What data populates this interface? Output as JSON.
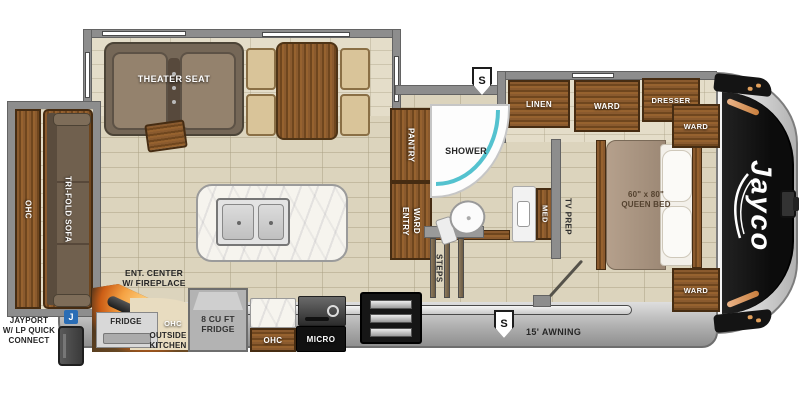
{
  "logo": {
    "brand": "Jayco"
  },
  "badges": {
    "s_top": "S",
    "s_bottom": "S",
    "jayport_j": "J"
  },
  "rear_slide": {
    "ohc": "OHC",
    "sofa": "TRI-FOLD SOFA"
  },
  "living": {
    "theater": "THEATER SEAT"
  },
  "outside_kitchen": {
    "ent_l1": "ENT. CENTER",
    "ent_l2": "W/ FIREPLACE",
    "fridge": "FRIDGE",
    "title_l1": "OUTSIDE",
    "title_l2": "KITCHEN",
    "ohc": "OHC"
  },
  "kitchen": {
    "fridge8_l1": "8 CU FT",
    "fridge8_l2": "FRIDGE",
    "ohc": "OHC",
    "micro": "MICRO",
    "pantry": "PANTRY",
    "entry_ward_l1": "ENTRY",
    "entry_ward_l2": "WARD"
  },
  "bath": {
    "shower": "SHOWER",
    "med": "MED",
    "tv_prep": "TV PREP",
    "steps": "STEPS"
  },
  "bedroom": {
    "linen": "LINEN",
    "ward_slide": "WARD",
    "dresser": "DRESSER",
    "ward_top": "WARD",
    "ward_bottom": "WARD",
    "bed_l1": "60\" x 80\"",
    "bed_l2": "QUEEN BED"
  },
  "exterior": {
    "awning": "15' AWNING",
    "jayport_l1": "JAYPORT",
    "jayport_l2": "W/ LP QUICK",
    "jayport_l3": "CONNECT"
  },
  "colors": {
    "accent_teal": "#54c2cf",
    "flame_orange": "#f5a243",
    "jayport_blue": "#2a6db5",
    "cap_black": "#141414",
    "wall_gray": "#8d8d8d",
    "floor_beige": "#dcd4bd",
    "wood_brown": "#8a5a2e"
  }
}
